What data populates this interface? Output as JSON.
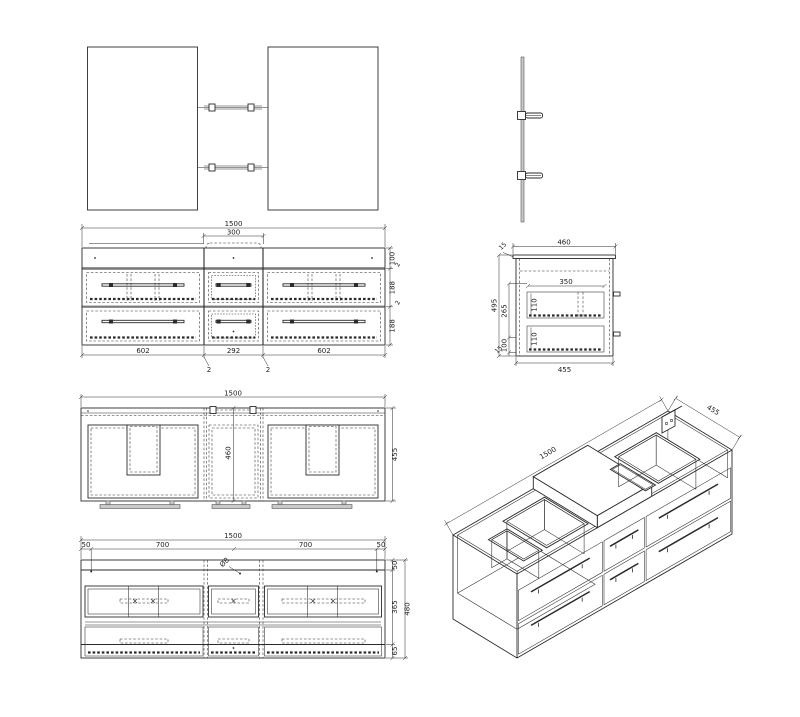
{
  "sheet": {
    "description": "Technical drawing of wall-hung double vanity cabinet with mirrors",
    "colors": {
      "line": "#2b2b2b",
      "background": "#ffffff",
      "gray_fill": "#c9c9c9"
    }
  },
  "views": {
    "front": {
      "width_total": "1500",
      "center_top_width": "300",
      "top_rail_height": "100",
      "gap_top": "2",
      "drawer_row1_height": "188",
      "gap_mid": "2",
      "drawer_row2_height": "188",
      "width_left": "602",
      "width_center": "292",
      "width_right": "602",
      "callout_left": "2",
      "callout_right": "2"
    },
    "side": {
      "width_top": "460",
      "top_thickness": "15",
      "height_total": "495",
      "inner_height": "265",
      "inner_bottom": "100",
      "bottom_thickness": "15",
      "drawer_inner_width": "350",
      "drawer1_height": "110",
      "drawer2_height": "110",
      "width_bottom": "455"
    },
    "plan": {
      "width_total": "1500",
      "depth_center": "460",
      "depth_right": "455"
    },
    "bottom": {
      "width_total": "1500",
      "offset_left": "50",
      "span_left": "700",
      "span_right": "700",
      "offset_right": "50",
      "band_top": "50",
      "band_mid": "365",
      "band_bottom": "65",
      "height_total": "480",
      "hole_diameter": "Ø8"
    },
    "iso": {
      "length": "1500",
      "depth": "455"
    }
  }
}
